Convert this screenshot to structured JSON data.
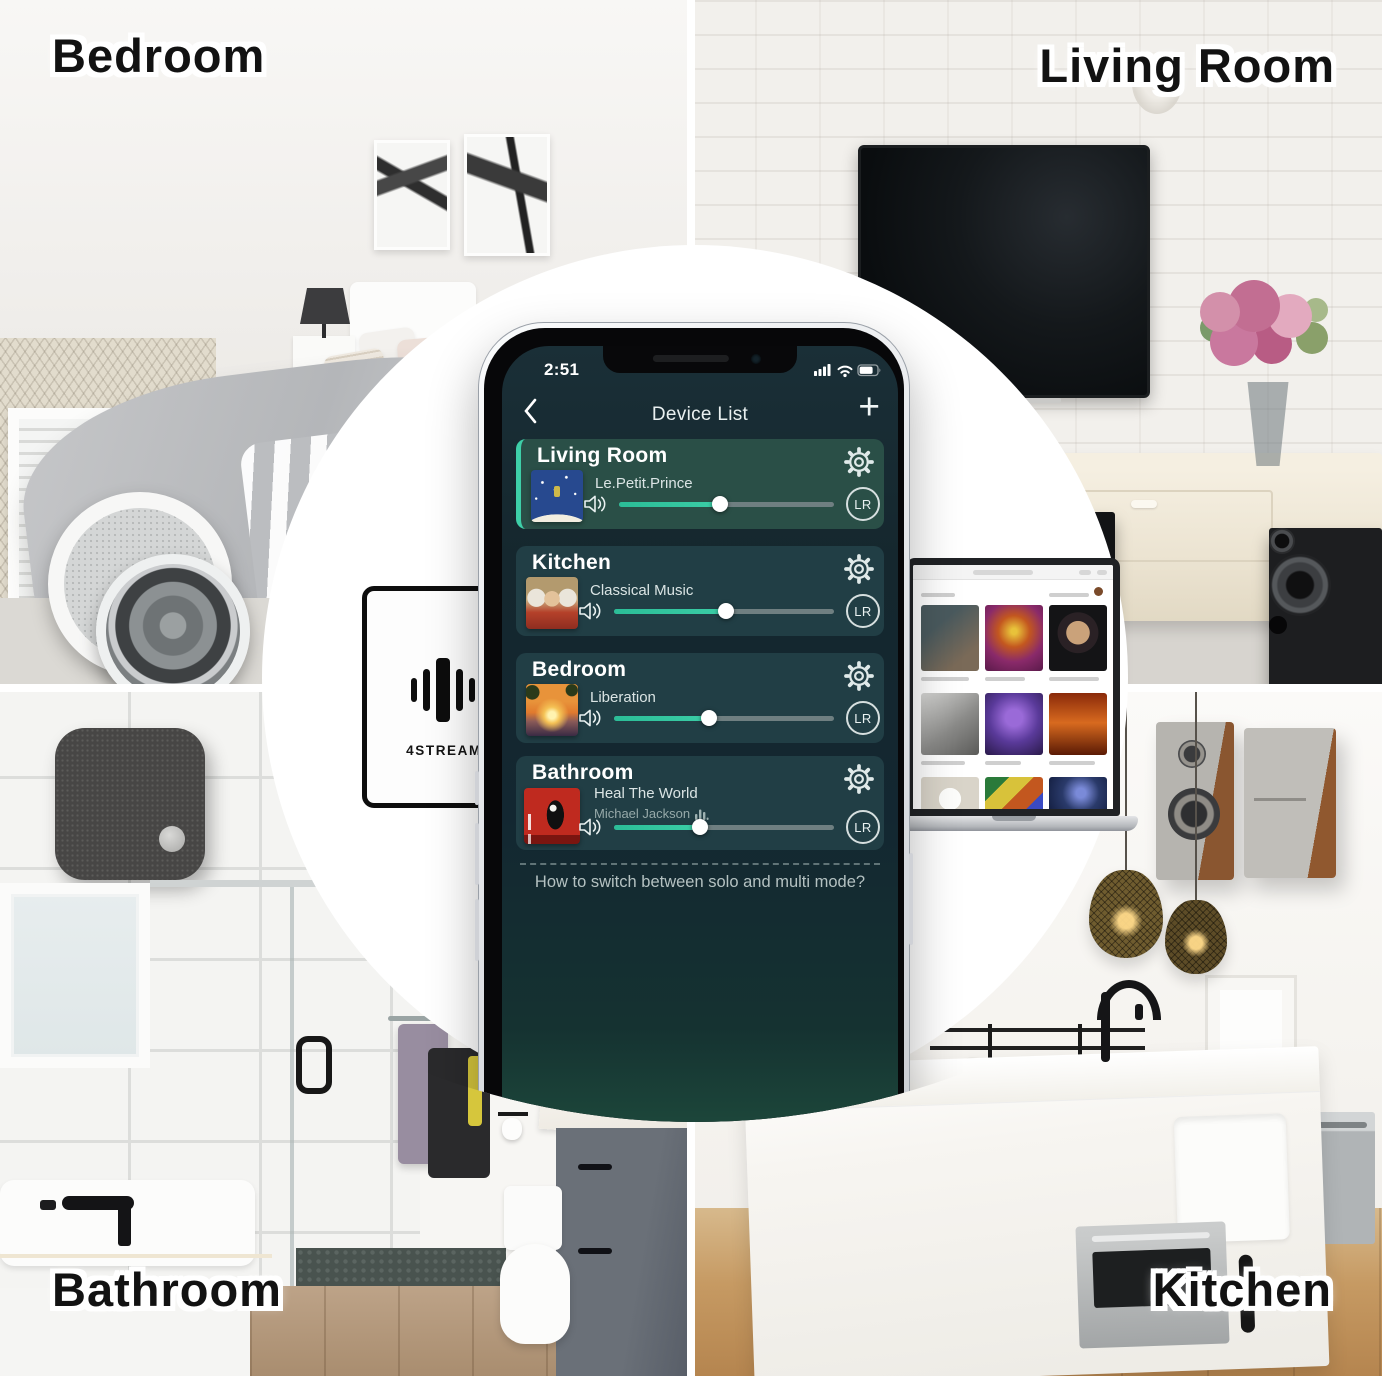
{
  "rooms": {
    "bedroom_label": "Bedroom",
    "living_room_label": "Living Room",
    "bathroom_label": "Bathroom",
    "kitchen_label": "Kitchen"
  },
  "brand_box": {
    "name": "4STREAM"
  },
  "phone": {
    "status_bar": {
      "time": "2:51",
      "icons": [
        "signal-icon",
        "wifi-icon",
        "battery-icon"
      ]
    },
    "nav": {
      "back_icon": "chevron-left-icon",
      "title": "Device List",
      "add_icon": "+"
    },
    "devices": [
      {
        "room": "Living Room",
        "now_playing": "Le.Petit.Prince",
        "artist": "",
        "volume_percent": 47,
        "channel_mode": "LR",
        "selected": true
      },
      {
        "room": "Kitchen",
        "now_playing": "Classical Music",
        "artist": "",
        "volume_percent": 51,
        "channel_mode": "LR",
        "selected": false
      },
      {
        "room": "Bedroom",
        "now_playing": "Liberation",
        "artist": "",
        "volume_percent": 43,
        "channel_mode": "LR",
        "selected": false
      },
      {
        "room": "Bathroom",
        "now_playing": "Heal The World",
        "artist": "Michael Jackson",
        "volume_percent": 39,
        "channel_mode": "LR",
        "selected": false
      }
    ],
    "footer_link": "How to switch between solo and multi mode?"
  },
  "colors": {
    "accent_teal": "#35C7A0",
    "screen_bg": "#142830",
    "card_bg": "#213E45",
    "card_selected_bg": "#2A4F47",
    "selected_border": "#3ECFA8",
    "slider_track": "#6F7F81"
  }
}
